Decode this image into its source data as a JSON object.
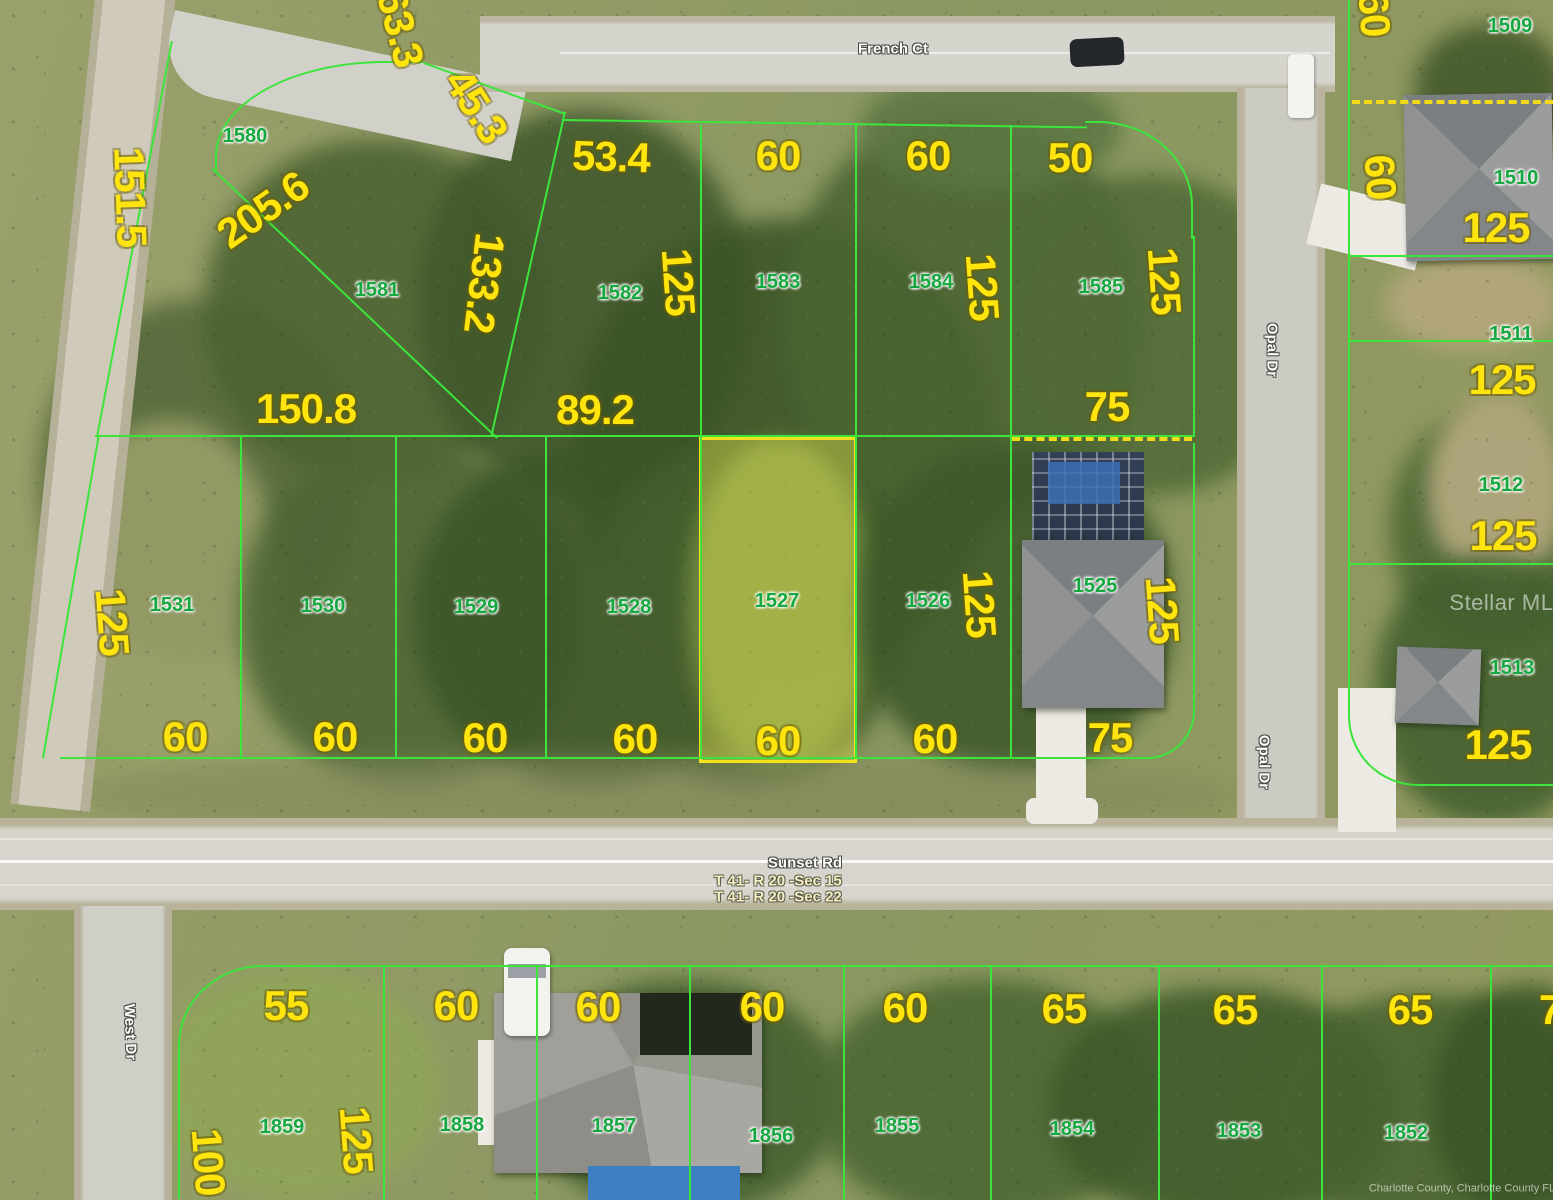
{
  "streets": {
    "top": "French Ct",
    "right": "Opal Dr",
    "middle": "Sunset Rd",
    "left": "West Dr"
  },
  "township_range_sections": [
    "T 41- R 20 -Sec 15",
    "T 41- R 20 -Sec 22"
  ],
  "highlighted_parcel": {
    "number": "1527",
    "frontage": "60",
    "depth": "125"
  },
  "watermark": "Stellar MLS",
  "attribution": "Charlotte County, Charlotte County FL",
  "colors": {
    "boundary_line": "#3ce53c",
    "dimension_text": "#ffe40e",
    "parcel_text": "#16a840",
    "highlight_border": "#f2e11c",
    "highlight_fill": "rgba(240,235,80,0.38)",
    "dashed_line": "#f2da1a"
  },
  "labels": [
    {
      "name": "dim-partial-63-3",
      "text": "63.3",
      "cls": "dim",
      "x": 400,
      "y": 28,
      "rot": 75
    },
    {
      "name": "dim-45-3",
      "text": "45.3",
      "cls": "dim",
      "x": 476,
      "y": 106,
      "rot": 57
    },
    {
      "name": "dim-151-5",
      "text": "151.5",
      "cls": "dim",
      "x": 130,
      "y": 197,
      "rot": 88
    },
    {
      "name": "dim-205-6",
      "text": "205.6",
      "cls": "dim",
      "x": 263,
      "y": 210,
      "rot": -35
    },
    {
      "name": "dim-53-4",
      "text": "53.4",
      "cls": "dim",
      "x": 611,
      "y": 157,
      "rot": 2
    },
    {
      "name": "dim-60-top-1",
      "text": "60",
      "cls": "dim",
      "x": 778,
      "y": 156,
      "rot": 0
    },
    {
      "name": "dim-60-top-2",
      "text": "60",
      "cls": "dim",
      "x": 928,
      "y": 156,
      "rot": 0
    },
    {
      "name": "dim-50-top",
      "text": "50",
      "cls": "dim",
      "x": 1070,
      "y": 158,
      "rot": 0
    },
    {
      "name": "dim-133-2",
      "text": "133.2",
      "cls": "dim",
      "x": 484,
      "y": 283,
      "rot": 97
    },
    {
      "name": "dim-125-1582",
      "text": "125",
      "cls": "dim",
      "x": 678,
      "y": 282,
      "rot": 86
    },
    {
      "name": "dim-125-1584",
      "text": "125",
      "cls": "dim",
      "x": 982,
      "y": 287,
      "rot": 86
    },
    {
      "name": "dim-125-1585",
      "text": "125",
      "cls": "dim",
      "x": 1164,
      "y": 281,
      "rot": 86
    },
    {
      "name": "dim-150-8",
      "text": "150.8",
      "cls": "dim",
      "x": 306,
      "y": 409,
      "rot": 0
    },
    {
      "name": "dim-89-2",
      "text": "89.2",
      "cls": "dim",
      "x": 595,
      "y": 410,
      "rot": 0
    },
    {
      "name": "dim-75-1585",
      "text": "75",
      "cls": "dim",
      "x": 1107,
      "y": 407,
      "rot": 0
    },
    {
      "name": "dim-125-1531",
      "text": "125",
      "cls": "dim",
      "x": 112,
      "y": 622,
      "rot": 86
    },
    {
      "name": "dim-125-1526",
      "text": "125",
      "cls": "dim",
      "x": 979,
      "y": 604,
      "rot": 86
    },
    {
      "name": "dim-125-1525",
      "text": "125",
      "cls": "dim",
      "x": 1162,
      "y": 610,
      "rot": 86
    },
    {
      "name": "dim-60-mid-1",
      "text": "60",
      "cls": "dim",
      "x": 185,
      "y": 737,
      "rot": 0
    },
    {
      "name": "dim-60-mid-2",
      "text": "60",
      "cls": "dim",
      "x": 335,
      "y": 737,
      "rot": 0
    },
    {
      "name": "dim-60-mid-3",
      "text": "60",
      "cls": "dim",
      "x": 485,
      "y": 738,
      "rot": 0
    },
    {
      "name": "dim-60-mid-4",
      "text": "60",
      "cls": "dim",
      "x": 635,
      "y": 739,
      "rot": 0
    },
    {
      "name": "dim-60-mid-5",
      "text": "60",
      "cls": "dim",
      "x": 778,
      "y": 741,
      "rot": 0
    },
    {
      "name": "dim-60-mid-6",
      "text": "60",
      "cls": "dim",
      "x": 935,
      "y": 739,
      "rot": 0
    },
    {
      "name": "dim-75-1525",
      "text": "75",
      "cls": "dim",
      "x": 1110,
      "y": 738,
      "rot": 0
    },
    {
      "name": "dim-60-r1",
      "text": "60",
      "cls": "dim",
      "x": 1374,
      "y": 14,
      "rot": 86
    },
    {
      "name": "dim-60-r2",
      "text": "60",
      "cls": "dim",
      "x": 1380,
      "y": 177,
      "rot": 86
    },
    {
      "name": "dim-125-r1",
      "text": "125",
      "cls": "dim",
      "x": 1496,
      "y": 228,
      "rot": 0
    },
    {
      "name": "dim-125-r2",
      "text": "125",
      "cls": "dim",
      "x": 1502,
      "y": 380,
      "rot": 0
    },
    {
      "name": "dim-125-r3",
      "text": "125",
      "cls": "dim",
      "x": 1503,
      "y": 536,
      "rot": 0
    },
    {
      "name": "dim-125-r4",
      "text": "125",
      "cls": "dim",
      "x": 1498,
      "y": 745,
      "rot": 0
    },
    {
      "name": "dim-55-bot",
      "text": "55",
      "cls": "dim",
      "x": 286,
      "y": 1006,
      "rot": 0
    },
    {
      "name": "dim-60-bot-1",
      "text": "60",
      "cls": "dim",
      "x": 456,
      "y": 1006,
      "rot": 0
    },
    {
      "name": "dim-60-bot-2",
      "text": "60",
      "cls": "dim",
      "x": 598,
      "y": 1007,
      "rot": 0
    },
    {
      "name": "dim-60-bot-3",
      "text": "60",
      "cls": "dim",
      "x": 762,
      "y": 1007,
      "rot": 0
    },
    {
      "name": "dim-60-bot-4",
      "text": "60",
      "cls": "dim",
      "x": 905,
      "y": 1008,
      "rot": 0
    },
    {
      "name": "dim-65-bot-1",
      "text": "65",
      "cls": "dim",
      "x": 1064,
      "y": 1009,
      "rot": 0
    },
    {
      "name": "dim-65-bot-2",
      "text": "65",
      "cls": "dim",
      "x": 1235,
      "y": 1010,
      "rot": 0
    },
    {
      "name": "dim-65-bot-3",
      "text": "65",
      "cls": "dim",
      "x": 1410,
      "y": 1010,
      "rot": 0
    },
    {
      "name": "dim-partial-7",
      "text": "7",
      "cls": "dim",
      "x": 1550,
      "y": 1010,
      "rot": 0
    },
    {
      "name": "dim-100-1859",
      "text": "100",
      "cls": "dim",
      "x": 208,
      "y": 1162,
      "rot": 86
    },
    {
      "name": "dim-125-1859",
      "text": "125",
      "cls": "dim",
      "x": 356,
      "y": 1140,
      "rot": 86
    },
    {
      "name": "parcel-1580",
      "text": "1580",
      "cls": "parcel",
      "x": 245,
      "y": 136,
      "rot": 0
    },
    {
      "name": "parcel-1581",
      "text": "1581",
      "cls": "parcel",
      "x": 377,
      "y": 290,
      "rot": 0
    },
    {
      "name": "parcel-1582",
      "text": "1582",
      "cls": "parcel",
      "x": 620,
      "y": 293,
      "rot": 0
    },
    {
      "name": "parcel-1583",
      "text": "1583",
      "cls": "parcel",
      "x": 778,
      "y": 282,
      "rot": 0
    },
    {
      "name": "parcel-1584",
      "text": "1584",
      "cls": "parcel",
      "x": 931,
      "y": 282,
      "rot": 0
    },
    {
      "name": "parcel-1585",
      "text": "1585",
      "cls": "parcel",
      "x": 1101,
      "y": 287,
      "rot": 0
    },
    {
      "name": "parcel-1509",
      "text": "1509",
      "cls": "parcel",
      "x": 1510,
      "y": 26,
      "rot": 0
    },
    {
      "name": "parcel-1510",
      "text": "1510",
      "cls": "parcel",
      "x": 1516,
      "y": 178,
      "rot": 0
    },
    {
      "name": "parcel-1511",
      "text": "1511",
      "cls": "parcel",
      "x": 1511,
      "y": 334,
      "rot": 0
    },
    {
      "name": "parcel-1512",
      "text": "1512",
      "cls": "parcel",
      "x": 1501,
      "y": 485,
      "rot": 0
    },
    {
      "name": "parcel-1513",
      "text": "1513",
      "cls": "parcel",
      "x": 1512,
      "y": 668,
      "rot": 0
    },
    {
      "name": "parcel-1531",
      "text": "1531",
      "cls": "parcel",
      "x": 172,
      "y": 605,
      "rot": 0
    },
    {
      "name": "parcel-1530",
      "text": "1530",
      "cls": "parcel",
      "x": 323,
      "y": 606,
      "rot": 0
    },
    {
      "name": "parcel-1529",
      "text": "1529",
      "cls": "parcel",
      "x": 476,
      "y": 607,
      "rot": 0
    },
    {
      "name": "parcel-1528",
      "text": "1528",
      "cls": "parcel",
      "x": 629,
      "y": 607,
      "rot": 0
    },
    {
      "name": "parcel-1527",
      "text": "1527",
      "cls": "parcel",
      "x": 777,
      "y": 601,
      "rot": 0
    },
    {
      "name": "parcel-1526",
      "text": "1526",
      "cls": "parcel",
      "x": 928,
      "y": 601,
      "rot": 0
    },
    {
      "name": "parcel-1525",
      "text": "1525",
      "cls": "parcel",
      "x": 1095,
      "y": 586,
      "rot": 0
    },
    {
      "name": "parcel-1859",
      "text": "1859",
      "cls": "parcel",
      "x": 282,
      "y": 1127,
      "rot": 0
    },
    {
      "name": "parcel-1858",
      "text": "1858",
      "cls": "parcel",
      "x": 462,
      "y": 1125,
      "rot": 0
    },
    {
      "name": "parcel-1857",
      "text": "1857",
      "cls": "parcel",
      "x": 614,
      "y": 1126,
      "rot": 0
    },
    {
      "name": "parcel-1856",
      "text": "1856",
      "cls": "parcel",
      "x": 771,
      "y": 1136,
      "rot": 0
    },
    {
      "name": "parcel-1855",
      "text": "1855",
      "cls": "parcel",
      "x": 897,
      "y": 1126,
      "rot": 0
    },
    {
      "name": "parcel-1854",
      "text": "1854",
      "cls": "parcel",
      "x": 1072,
      "y": 1129,
      "rot": 0
    },
    {
      "name": "parcel-1853",
      "text": "1853",
      "cls": "parcel",
      "x": 1239,
      "y": 1131,
      "rot": 0
    },
    {
      "name": "parcel-1852",
      "text": "1852",
      "cls": "parcel",
      "x": 1406,
      "y": 1133,
      "rot": 0
    },
    {
      "name": "street-french-ct",
      "text": "French Ct",
      "cls": "street",
      "x": 893,
      "y": 49,
      "rot": 0
    },
    {
      "name": "street-opal-dr-north",
      "text": "Opal Dr",
      "cls": "street",
      "x": 1272,
      "y": 350,
      "rot": 90
    },
    {
      "name": "street-opal-dr-south",
      "text": "Opal Dr",
      "cls": "street",
      "x": 1264,
      "y": 762,
      "rot": 90
    },
    {
      "name": "street-sunset-rd",
      "text": "Sunset Rd",
      "cls": "street",
      "x": 805,
      "y": 863,
      "rot": 0
    },
    {
      "name": "street-west-dr",
      "text": "West Dr",
      "cls": "street",
      "x": 130,
      "y": 1032,
      "rot": 88
    },
    {
      "name": "section-label-15",
      "text": "T 41- R 20 -Sec 15",
      "cls": "section",
      "x": 778,
      "y": 881,
      "rot": 0
    },
    {
      "name": "section-label-22",
      "text": "T 41- R 20 -Sec 22",
      "cls": "section",
      "x": 778,
      "y": 897,
      "rot": 0
    },
    {
      "name": "stellar-mls-watermark",
      "text": "Stellar MLS",
      "cls": "watermark",
      "x": 1509,
      "y": 603,
      "rot": 0
    },
    {
      "name": "county-attribution",
      "text": "Charlotte County, Charlotte County FL",
      "cls": "copyright",
      "x": 1462,
      "y": 1189,
      "rot": 0
    }
  ]
}
